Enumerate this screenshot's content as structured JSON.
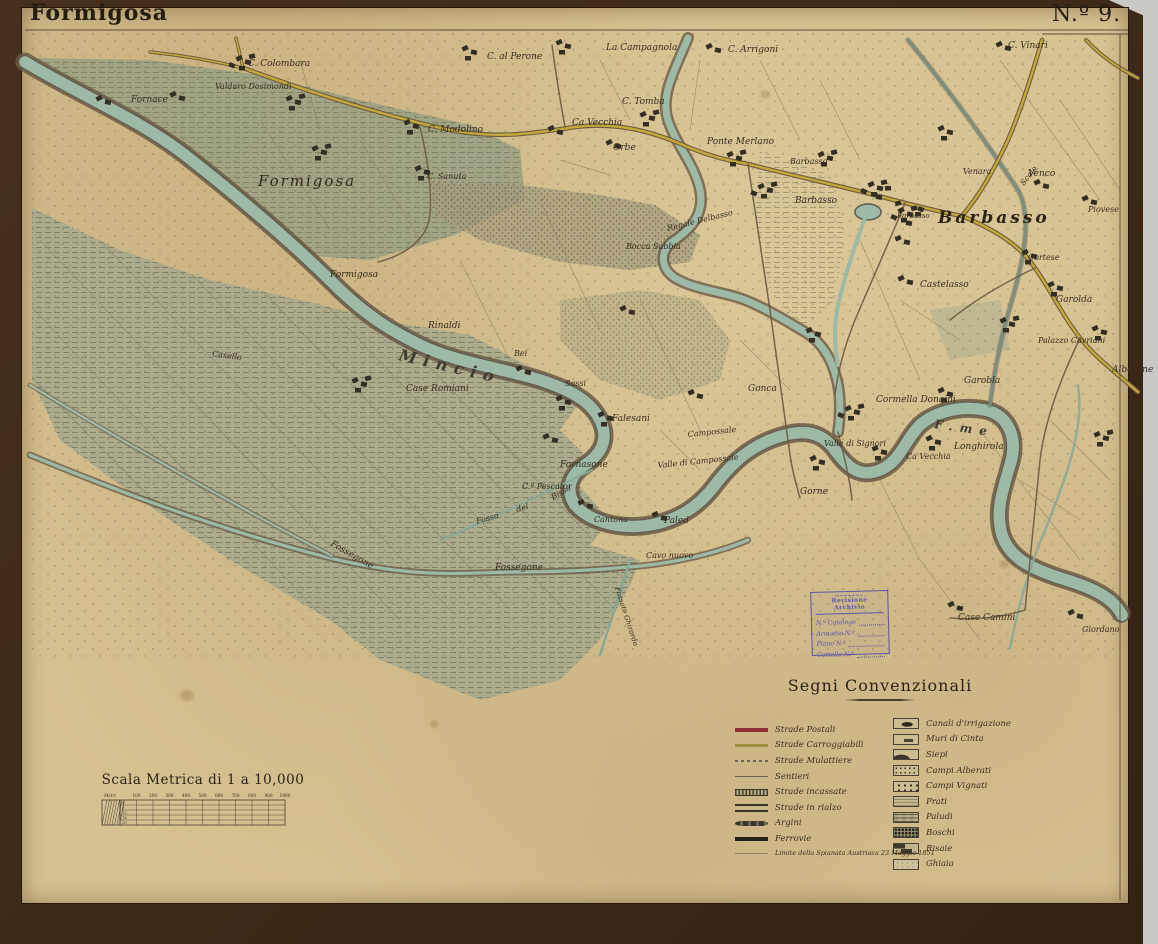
{
  "header": {
    "title": "Formigosa",
    "sheet_number": "N.º 9."
  },
  "colors": {
    "paper": "#d6c190",
    "mat": "#46301c",
    "river": "#9cbaa6",
    "road_postale": "#8d2f39",
    "road_carreggiabile": "#b49a33",
    "stamp_blue": "#5e55a6"
  },
  "legend": {
    "title": "Segni Convenzionali",
    "left": [
      {
        "key": "postali",
        "label": "Strade Postali"
      },
      {
        "key": "carroggiabili",
        "label": "Strade Carroggiabili"
      },
      {
        "key": "mulattiere",
        "label": "Strade Mulattiere"
      },
      {
        "key": "sentieri",
        "label": "Sentieri"
      },
      {
        "key": "incassate",
        "label": "Strade incassate"
      },
      {
        "key": "rialzo",
        "label": "Strade in rialzo"
      },
      {
        "key": "argini",
        "label": "Argini"
      },
      {
        "key": "ferrovie",
        "label": "Ferrovie"
      }
    ],
    "note": "Limite della Spianata Austriaca 23 Maggio 1851",
    "right": [
      {
        "key": "canali",
        "label": "Canali d'irrigazione"
      },
      {
        "key": "muri",
        "label": "Muri di Cinta"
      },
      {
        "key": "siepi",
        "label": "Siepi"
      },
      {
        "key": "alberati",
        "label": "Campi Alberati"
      },
      {
        "key": "vignati",
        "label": "Campi Vignati"
      },
      {
        "key": "prati",
        "label": "Prati"
      },
      {
        "key": "paludi",
        "label": "Paludi"
      },
      {
        "key": "boschi",
        "label": "Boschi"
      },
      {
        "key": "risaie",
        "label": "Risaie"
      },
      {
        "key": "ghiaia",
        "label": "Ghiaia"
      }
    ]
  },
  "scale": {
    "title": "Scala Metrica di 1 a 10,000",
    "unit": "Metri",
    "ticks": [
      "100",
      "200",
      "300",
      "400",
      "500",
      "600",
      "700",
      "800",
      "900",
      "1000"
    ],
    "rows": [
      "4",
      "8",
      "12",
      "16",
      "20"
    ]
  },
  "stamp": {
    "title": "Revisione Archivio",
    "fields": [
      "N.º Catalogo",
      "Armadio N.º",
      "Piano N.º",
      "Cartella N.º"
    ]
  },
  "map": {
    "labels": [
      {
        "t": "C. Colombara",
        "x": 248,
        "y": 66,
        "s": 9
      },
      {
        "t": "Valdaro Dosimondi",
        "x": 215,
        "y": 89,
        "s": 8
      },
      {
        "t": "Fornace",
        "x": 131,
        "y": 102,
        "s": 9
      },
      {
        "t": "Formigosa",
        "x": 258,
        "y": 186,
        "s": 15,
        "cls": "town"
      },
      {
        "t": "C. Modolino",
        "x": 428,
        "y": 132,
        "s": 9
      },
      {
        "t": "C. Sanuta",
        "x": 427,
        "y": 179,
        "s": 8
      },
      {
        "t": "C. al Perone",
        "x": 487,
        "y": 59,
        "s": 9
      },
      {
        "t": "La Campagnola",
        "x": 606,
        "y": 50,
        "s": 9
      },
      {
        "t": "C. Arrigoni",
        "x": 728,
        "y": 52,
        "s": 9
      },
      {
        "t": "C. Tomba",
        "x": 622,
        "y": 104,
        "s": 9
      },
      {
        "t": "Ca Vecchia",
        "x": 572,
        "y": 125,
        "s": 9
      },
      {
        "t": "Orbe",
        "x": 613,
        "y": 150,
        "s": 9
      },
      {
        "t": "Ponte Merlano",
        "x": 707,
        "y": 144,
        "s": 9
      },
      {
        "t": "Barbasso",
        "x": 790,
        "y": 164,
        "s": 8
      },
      {
        "t": "Barbasso",
        "x": 795,
        "y": 203,
        "s": 9
      },
      {
        "t": "Barbasso",
        "x": 897,
        "y": 218,
        "s": 7
      },
      {
        "t": "Barbasso",
        "x": 938,
        "y": 223,
        "s": 17,
        "cls": "town-big"
      },
      {
        "t": "Venara",
        "x": 963,
        "y": 174,
        "s": 8
      },
      {
        "t": "Venco",
        "x": 1028,
        "y": 176,
        "s": 9
      },
      {
        "t": "C. Vinari",
        "x": 1008,
        "y": 48,
        "s": 9
      },
      {
        "t": "Piovese",
        "x": 1088,
        "y": 212,
        "s": 8
      },
      {
        "t": "Cortese",
        "x": 1028,
        "y": 260,
        "s": 8
      },
      {
        "t": "Garolda",
        "x": 1056,
        "y": 302,
        "s": 9
      },
      {
        "t": "Palazzo Cavriani",
        "x": 1038,
        "y": 343,
        "s": 8
      },
      {
        "t": "Alberone",
        "x": 1112,
        "y": 372,
        "s": 9
      },
      {
        "t": "Garobla",
        "x": 964,
        "y": 383,
        "s": 9
      },
      {
        "t": "Castelasso",
        "x": 920,
        "y": 287,
        "s": 9
      },
      {
        "t": "Cormella Donaini",
        "x": 876,
        "y": 402,
        "s": 9
      },
      {
        "t": "Scolo",
        "x": 1024,
        "y": 186,
        "s": 8,
        "r": -52
      },
      {
        "t": "Regale Delbasso",
        "x": 668,
        "y": 231,
        "s": 8,
        "r": -14
      },
      {
        "t": "Bocca Sabbia",
        "x": 626,
        "y": 249,
        "s": 8
      },
      {
        "t": "Formigosa",
        "x": 330,
        "y": 277,
        "s": 9
      },
      {
        "t": "Rinaldi",
        "x": 428,
        "y": 328,
        "s": 9
      },
      {
        "t": "Casello",
        "x": 212,
        "y": 356,
        "s": 8,
        "r": 8
      },
      {
        "t": "Mincio",
        "x": 398,
        "y": 360,
        "s": 16,
        "cls": "river",
        "r": 13
      },
      {
        "t": "Case Romiani",
        "x": 406,
        "y": 391,
        "s": 9
      },
      {
        "t": "Bei",
        "x": 514,
        "y": 356,
        "s": 8
      },
      {
        "t": "Sassi",
        "x": 565,
        "y": 386,
        "s": 8
      },
      {
        "t": "Falesani",
        "x": 612,
        "y": 421,
        "s": 9
      },
      {
        "t": "Gonca",
        "x": 748,
        "y": 391,
        "s": 9
      },
      {
        "t": "Campossale",
        "x": 688,
        "y": 437,
        "s": 8,
        "r": -6
      },
      {
        "t": "Valle di Campossale",
        "x": 658,
        "y": 468,
        "s": 8,
        "r": -6
      },
      {
        "t": "Fornasone",
        "x": 560,
        "y": 467,
        "s": 9
      },
      {
        "t": "C.ª Pescator",
        "x": 522,
        "y": 489,
        "s": 8
      },
      {
        "t": "Fosso",
        "x": 477,
        "y": 524,
        "s": 8,
        "r": -16
      },
      {
        "t": "del",
        "x": 517,
        "y": 512,
        "s": 8,
        "r": -16
      },
      {
        "t": "Bisso",
        "x": 553,
        "y": 500,
        "s": 8,
        "r": -30
      },
      {
        "t": "Cantona",
        "x": 594,
        "y": 522,
        "s": 8
      },
      {
        "t": "Paled",
        "x": 664,
        "y": 523,
        "s": 9
      },
      {
        "t": "Cavo nuovo",
        "x": 646,
        "y": 558,
        "s": 8
      },
      {
        "t": "Fossegone",
        "x": 330,
        "y": 545,
        "s": 9,
        "r": 30
      },
      {
        "t": "Fossegone",
        "x": 495,
        "y": 570,
        "s": 9
      },
      {
        "t": "Fossato Ghirardo",
        "x": 615,
        "y": 588,
        "s": 7,
        "r": 72
      },
      {
        "t": "Gorne",
        "x": 800,
        "y": 494,
        "s": 9
      },
      {
        "t": "Valle di Signori",
        "x": 824,
        "y": 446,
        "s": 8
      },
      {
        "t": "Ca Vecchia",
        "x": 906,
        "y": 459,
        "s": 8
      },
      {
        "t": "Longhirola",
        "x": 954,
        "y": 449,
        "s": 9
      },
      {
        "t": "F.me",
        "x": 934,
        "y": 428,
        "s": 12,
        "cls": "river",
        "r": 8
      },
      {
        "t": "Case Camini",
        "x": 958,
        "y": 620,
        "s": 9
      },
      {
        "t": "Giordano",
        "x": 1082,
        "y": 632,
        "s": 8
      }
    ],
    "buildings": [
      [
        236,
        56,
        5
      ],
      [
        286,
        96,
        4
      ],
      [
        312,
        146,
        4
      ],
      [
        170,
        92,
        2
      ],
      [
        96,
        96,
        2
      ],
      [
        404,
        120,
        3
      ],
      [
        415,
        166,
        3
      ],
      [
        462,
        46,
        3
      ],
      [
        556,
        40,
        3
      ],
      [
        706,
        44,
        2
      ],
      [
        640,
        112,
        4
      ],
      [
        548,
        126,
        2
      ],
      [
        606,
        140,
        2
      ],
      [
        727,
        152,
        4
      ],
      [
        758,
        184,
        5
      ],
      [
        818,
        152,
        4
      ],
      [
        868,
        182,
        7
      ],
      [
        898,
        208,
        9
      ],
      [
        938,
        126,
        3
      ],
      [
        1034,
        180,
        2
      ],
      [
        1082,
        196,
        2
      ],
      [
        996,
        42,
        2
      ],
      [
        1022,
        250,
        3
      ],
      [
        1048,
        282,
        3
      ],
      [
        1000,
        318,
        4
      ],
      [
        1092,
        326,
        3
      ],
      [
        895,
        236,
        2
      ],
      [
        898,
        276,
        2
      ],
      [
        938,
        388,
        3
      ],
      [
        845,
        406,
        5
      ],
      [
        352,
        378,
        4
      ],
      [
        556,
        396,
        3
      ],
      [
        598,
        412,
        3
      ],
      [
        516,
        366,
        2
      ],
      [
        543,
        434,
        2
      ],
      [
        578,
        500,
        2
      ],
      [
        652,
        512,
        2
      ],
      [
        810,
        456,
        3
      ],
      [
        872,
        446,
        3
      ],
      [
        926,
        436,
        3
      ],
      [
        948,
        602,
        2
      ],
      [
        1068,
        610,
        2
      ],
      [
        1094,
        432,
        4
      ],
      [
        620,
        306,
        2
      ],
      [
        688,
        390,
        2
      ],
      [
        806,
        328,
        3
      ]
    ]
  }
}
